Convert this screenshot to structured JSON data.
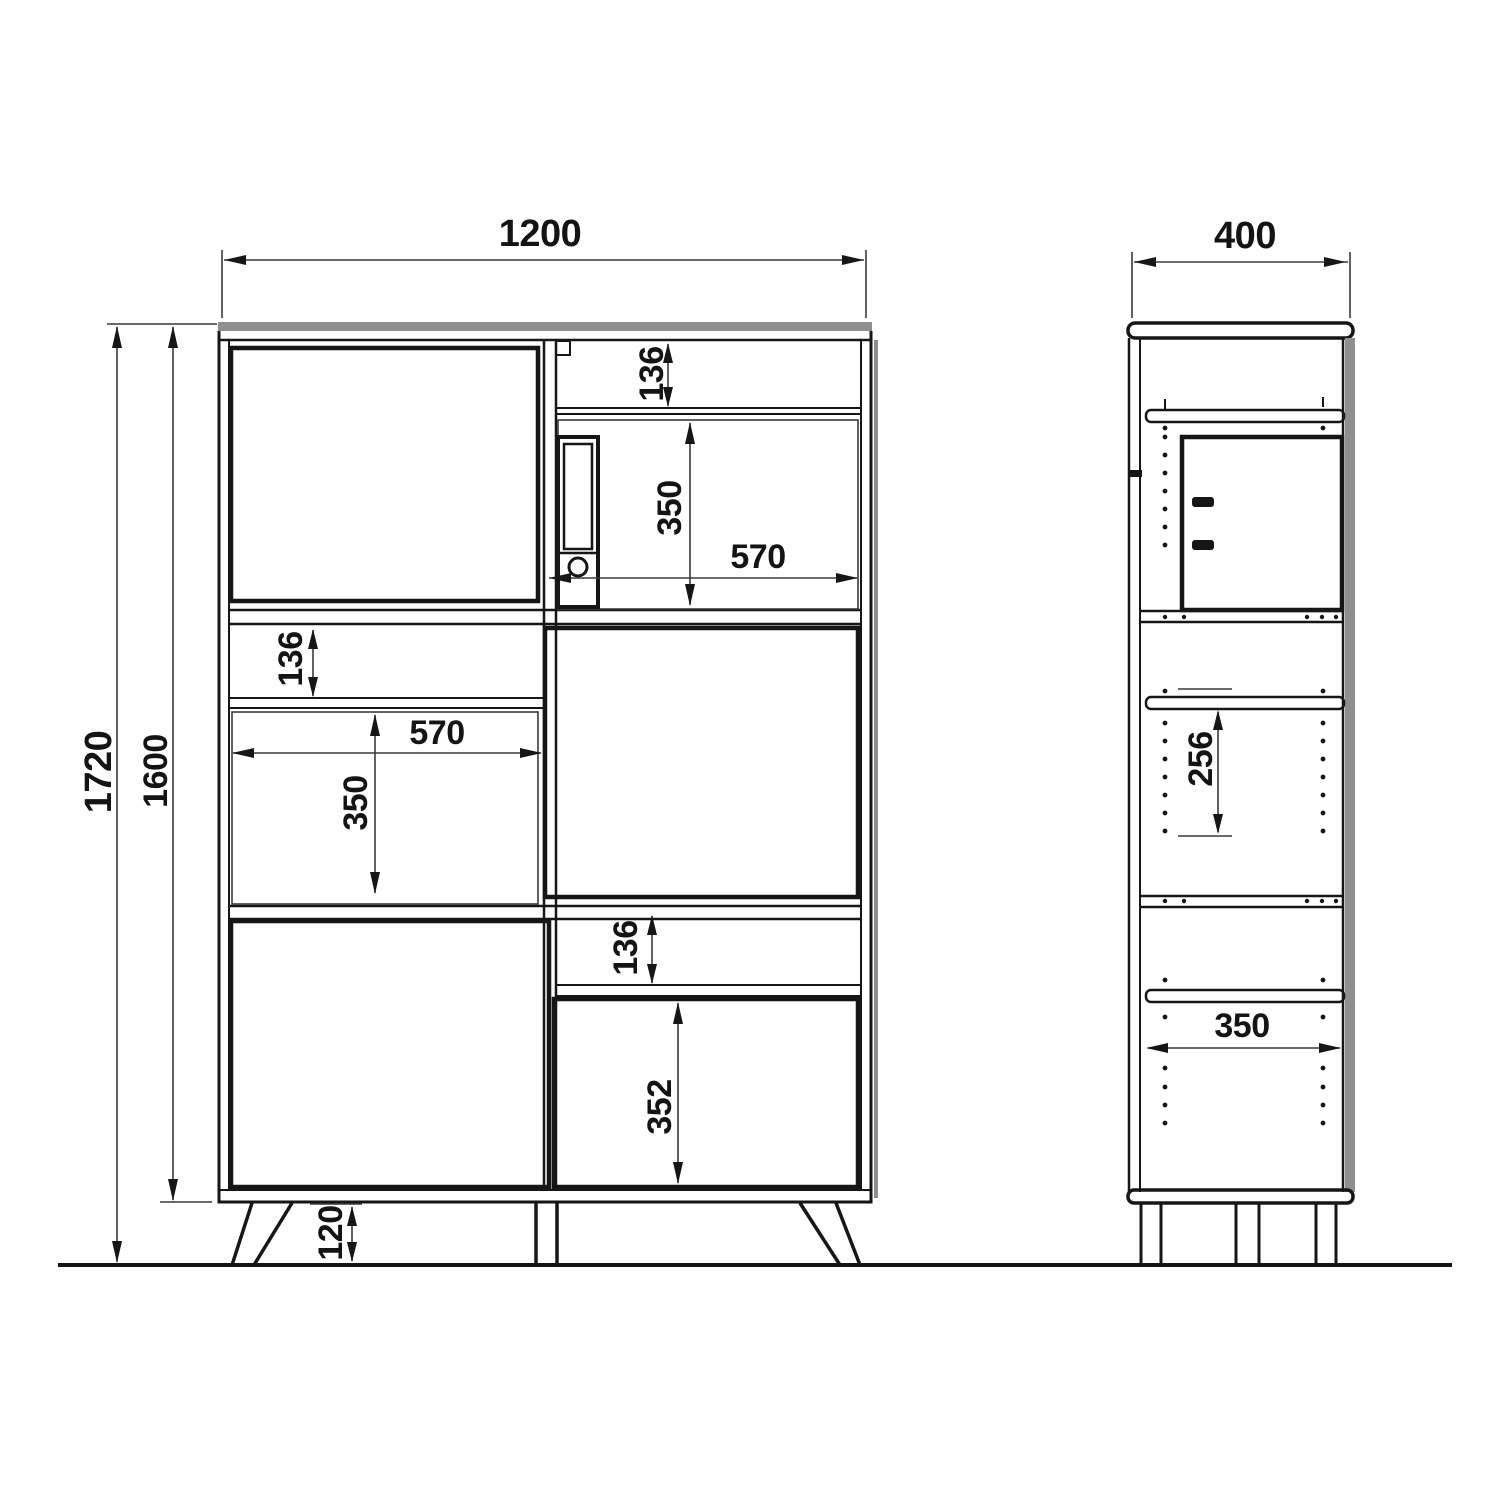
{
  "front_view": {
    "overall_width": "1200",
    "total_height": "1720",
    "carcass_height": "1600",
    "leg_height": "120",
    "top_drawer_height": "136",
    "top_compartment_height": "350",
    "top_compartment_width": "570",
    "middle_drawer_height": "136",
    "middle_compartment_width": "570",
    "middle_compartment_height": "350",
    "bottom_drawer_height": "136",
    "bottom_door_height": "352"
  },
  "side_view": {
    "overall_depth": "400",
    "shelf_spacing": "256",
    "interior_depth": "350"
  }
}
